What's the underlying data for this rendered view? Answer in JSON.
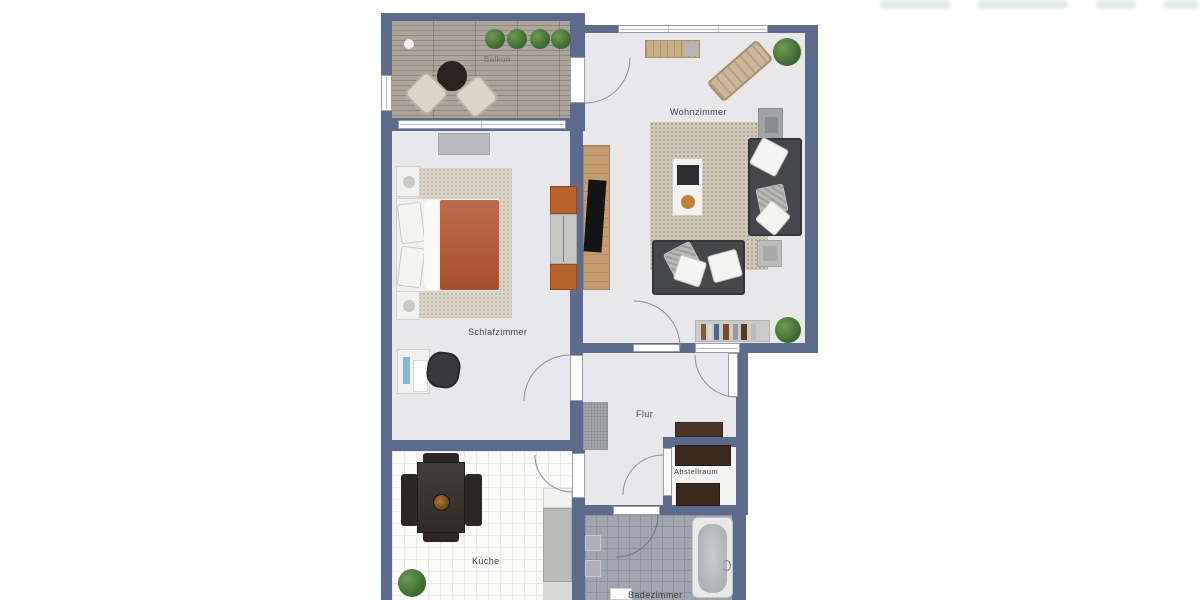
{
  "floorplan": {
    "type": "apartment-floorplan",
    "wall_color": "#5c6b8c",
    "floor_color": "#e8e8ea",
    "rooms": [
      {
        "id": "balkon",
        "label": "Balkon",
        "floor": "wood deck",
        "items": [
          "round table",
          "wicker chair",
          "wicker chair",
          "4 potted plants"
        ]
      },
      {
        "id": "wohnzimmer",
        "label": "Wohnzimmer",
        "floor": "light gray",
        "items": [
          "sideboard",
          "sun lounger",
          "potted plant",
          "area rug",
          "coffee table",
          "sofa right",
          "sofa bottom",
          "side table",
          "tv lowboard",
          "wall cabinet",
          "bookshelf",
          "potted plant"
        ]
      },
      {
        "id": "schlafzimmer",
        "label": "Schlafzimmer",
        "floor": "light gray",
        "items": [
          "sideboard",
          "double bed with terracotta duvet",
          "nightstand",
          "nightstand",
          "rug",
          "wardrobe",
          "desk",
          "office chair"
        ]
      },
      {
        "id": "flur",
        "label": "Flur",
        "floor": "light gray",
        "items": [
          "gray cabinet",
          "brown sideboard"
        ]
      },
      {
        "id": "abstellraum",
        "label": "Abstellraum",
        "floor": "white",
        "items": [
          "shelf",
          "shelf"
        ]
      },
      {
        "id": "kueche",
        "label": "Küche",
        "floor": "white tiles",
        "items": [
          "dining table with 4 chairs",
          "fruit bowl",
          "potted plant",
          "kitchen counter"
        ]
      },
      {
        "id": "badezimmer",
        "label": "Badezimmer",
        "floor": "gray tiles",
        "items": [
          "bathtub",
          "fixture",
          "fixture",
          "washbasin"
        ]
      }
    ],
    "doors": [
      "balcony-door",
      "living-room-door",
      "entrance-door",
      "bedroom-door",
      "kitchen-door",
      "storage-door",
      "bathroom-door"
    ],
    "windows": [
      "living-room-top-window",
      "bedroom-balcony-window",
      "balcony-side-window"
    ],
    "colors": {
      "duvet": "#b15431",
      "sofa": "#46474b",
      "wood": "#c59d6e",
      "wardrobe_wood": "#b4622e",
      "plant": "#3f6f33",
      "deck": "#a79d94",
      "bath_tile": "#a0a5b0",
      "dark_cabinet": "#3a2a1e"
    }
  },
  "watermark": {
    "visible": true
  }
}
